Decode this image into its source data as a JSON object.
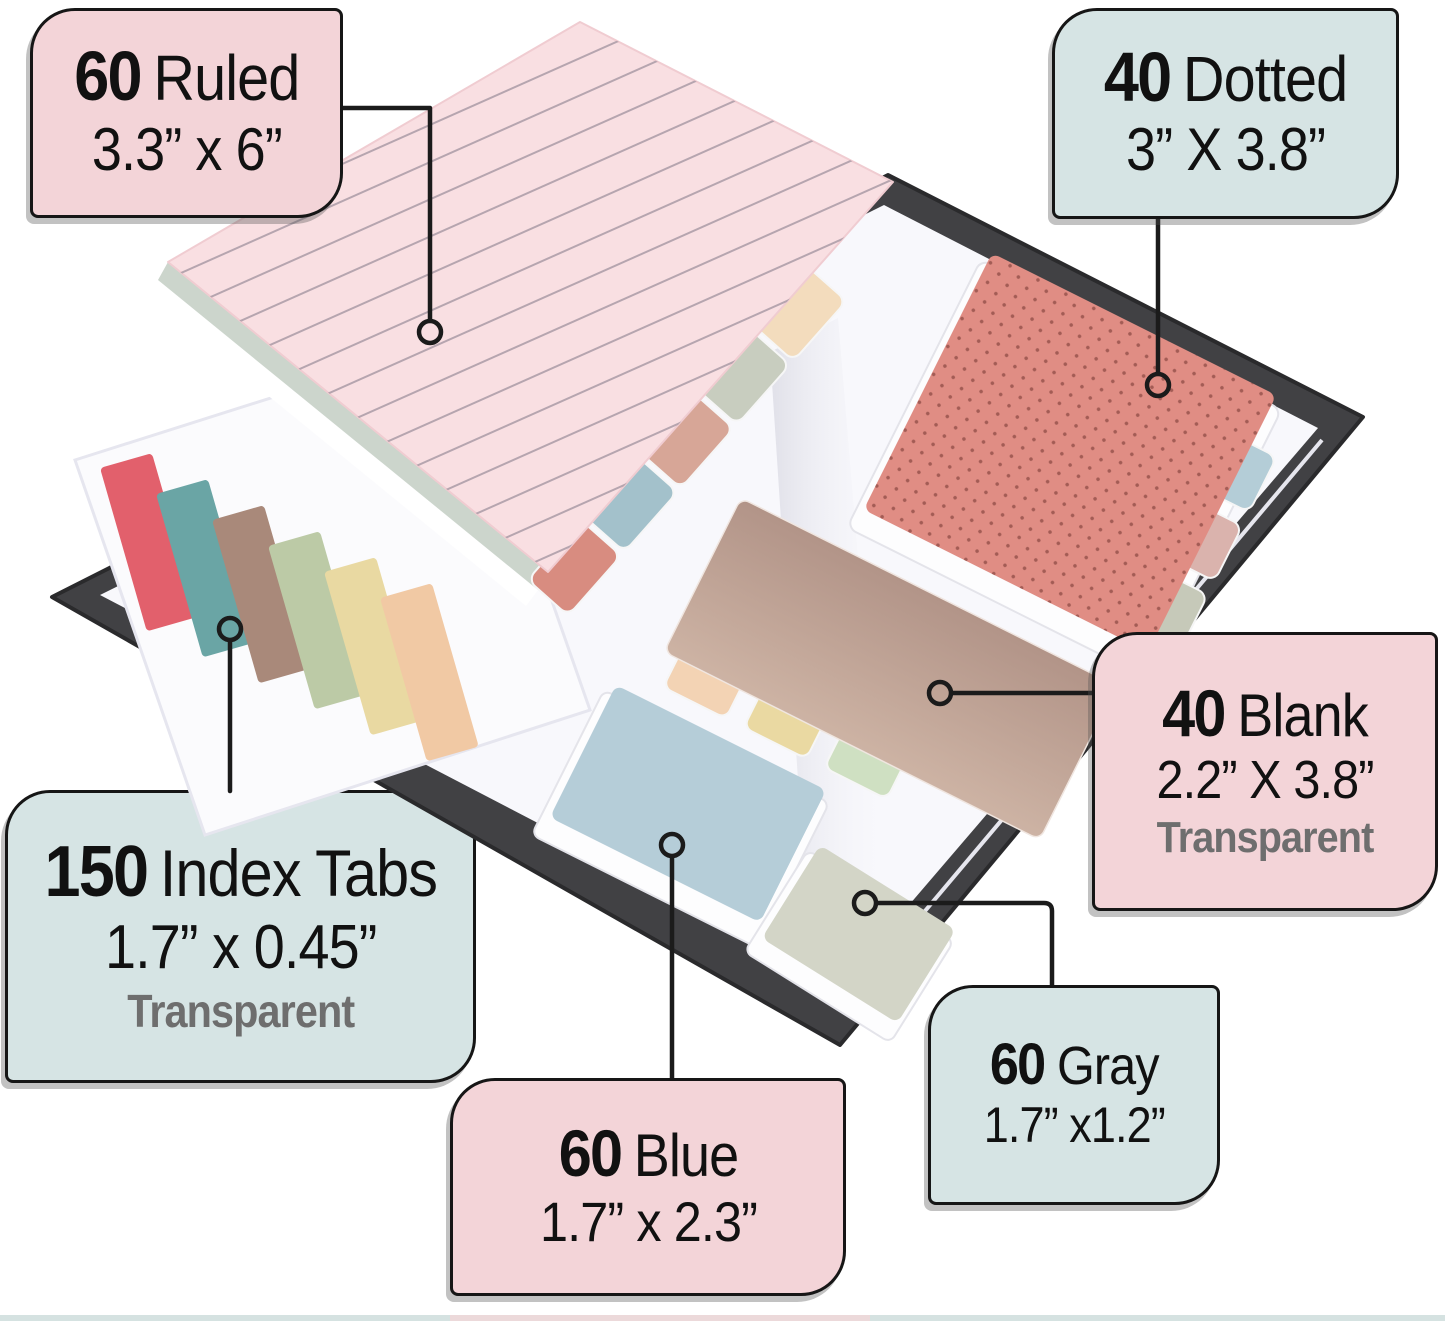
{
  "callouts": [
    {
      "id": "ruled",
      "count": "60",
      "label": "Ruled",
      "size": "3.3” x 6”"
    },
    {
      "id": "dotted",
      "count": "40",
      "label": "Dotted",
      "size": "3” X 3.8”"
    },
    {
      "id": "index",
      "count": "150",
      "label": "Index Tabs",
      "size": "1.7” x 0.45”",
      "note": "Transparent"
    },
    {
      "id": "blank",
      "count": "40",
      "label": "Blank",
      "size": "2.2” X 3.8”",
      "note": "Transparent"
    },
    {
      "id": "blue",
      "count": "60",
      "label": "Blue",
      "size": "1.7” x 2.3”"
    },
    {
      "id": "gray",
      "count": "60",
      "label": "Gray",
      "size": "1.7” x1.2”"
    }
  ],
  "icons": {
    "marker": "circle-endpoint-icon"
  },
  "colors": {
    "background": "#ffffff",
    "callout_pink": "#f3d4d8",
    "callout_blue": "#d6e4e4",
    "callout_border": "#161616",
    "transparent_note": "#6e6e6e",
    "leader": "#1b1b1b",
    "cover": "#414144",
    "cover_edge": "#2a2a2c",
    "page": "#f8f8fc",
    "sheet_edge": "#e6e6ee",
    "ruled_pad": "#f9dfe2",
    "ruled_line": "#b3a2ac",
    "dotted_pad": "#e08d84",
    "dot": "#a35c55",
    "blank_top": "#b29488",
    "blank_bottom": "#cdb3a4",
    "blue_pad": "#b5cdd8",
    "gray_pad": "#d3d5c7",
    "strip_red": "#e2606c",
    "strip_teal": "#6aa5a5",
    "strip_brown": "#a9897a",
    "strip_green": "#bccaa6",
    "strip_yellow": "#e9d9a2",
    "strip_peach": "#f1c9a4",
    "rtab_cream": "#f3dcbd",
    "rtab_sage": "#c8cdbf",
    "rtab_rose": "#d7a697",
    "rtab_blue": "#a3c1cb",
    "rtab_salmon": "#d88c80",
    "dtab_blue": "#b4cdd7",
    "dtab_pink": "#dab3ad",
    "dtab_green": "#c6c9b9",
    "btab_peach": "#f3d3b4",
    "btab_yellow": "#ead9a2",
    "btab_green": "#cfe0c2",
    "bottom_strip": "#d5e2e1",
    "bottom_strip_accent": "#ecd9da"
  }
}
